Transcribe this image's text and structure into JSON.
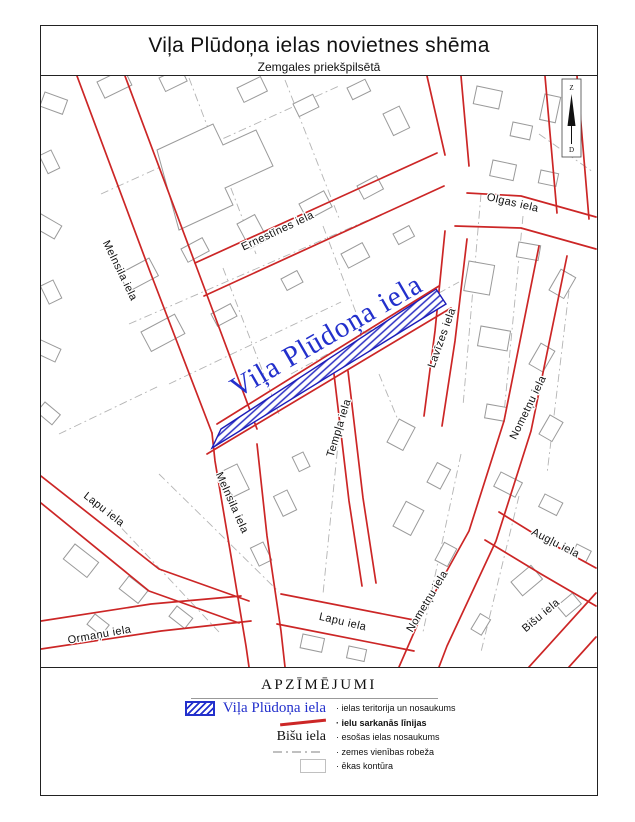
{
  "page": {
    "title": "Viļa Plūdoņa ielas novietnes shēma",
    "subtitle": "Zemgales priekšpilsētā"
  },
  "map": {
    "highlight_street": "Viļa Plūdoņa iela",
    "north": {
      "top": "Z",
      "bottom": "D"
    },
    "streets": {
      "melnsila_nw": "Melnsila iela",
      "ernestines": "Ernestīnes iela",
      "olgas": "Olgas iela",
      "lavizes": "Lavīzes iela",
      "templa": "Tempļa iela",
      "nometnu_e": "Nometņu iela",
      "melnsila_mid": "Melnsila iela",
      "lapu_w": "Lapu iela",
      "ormanu": "Ormaņu iela",
      "lapu_s": "Lapu iela",
      "nometnu_s": "Nometņu iela",
      "bisu": "Bišu iela",
      "auglu": "Augļu iela"
    }
  },
  "legend": {
    "title": "APZĪMĒJUMI",
    "items": [
      {
        "label": "Viļa Plūdoņa iela",
        "desc": "· ielas teritorija un nosaukums"
      },
      {
        "desc": "· ielu sarkanās līnijas"
      },
      {
        "label": "Bišu iela",
        "desc": "· esošas ielas nosaukums"
      },
      {
        "desc": "· zemes vienības robeža"
      },
      {
        "desc": "· ēkas kontūra"
      }
    ]
  },
  "colors": {
    "red_line": "#cc2626",
    "highlight_blue": "#2330cc",
    "building_outline": "#9a9a9a",
    "parcel_line": "#b4b4b4"
  }
}
